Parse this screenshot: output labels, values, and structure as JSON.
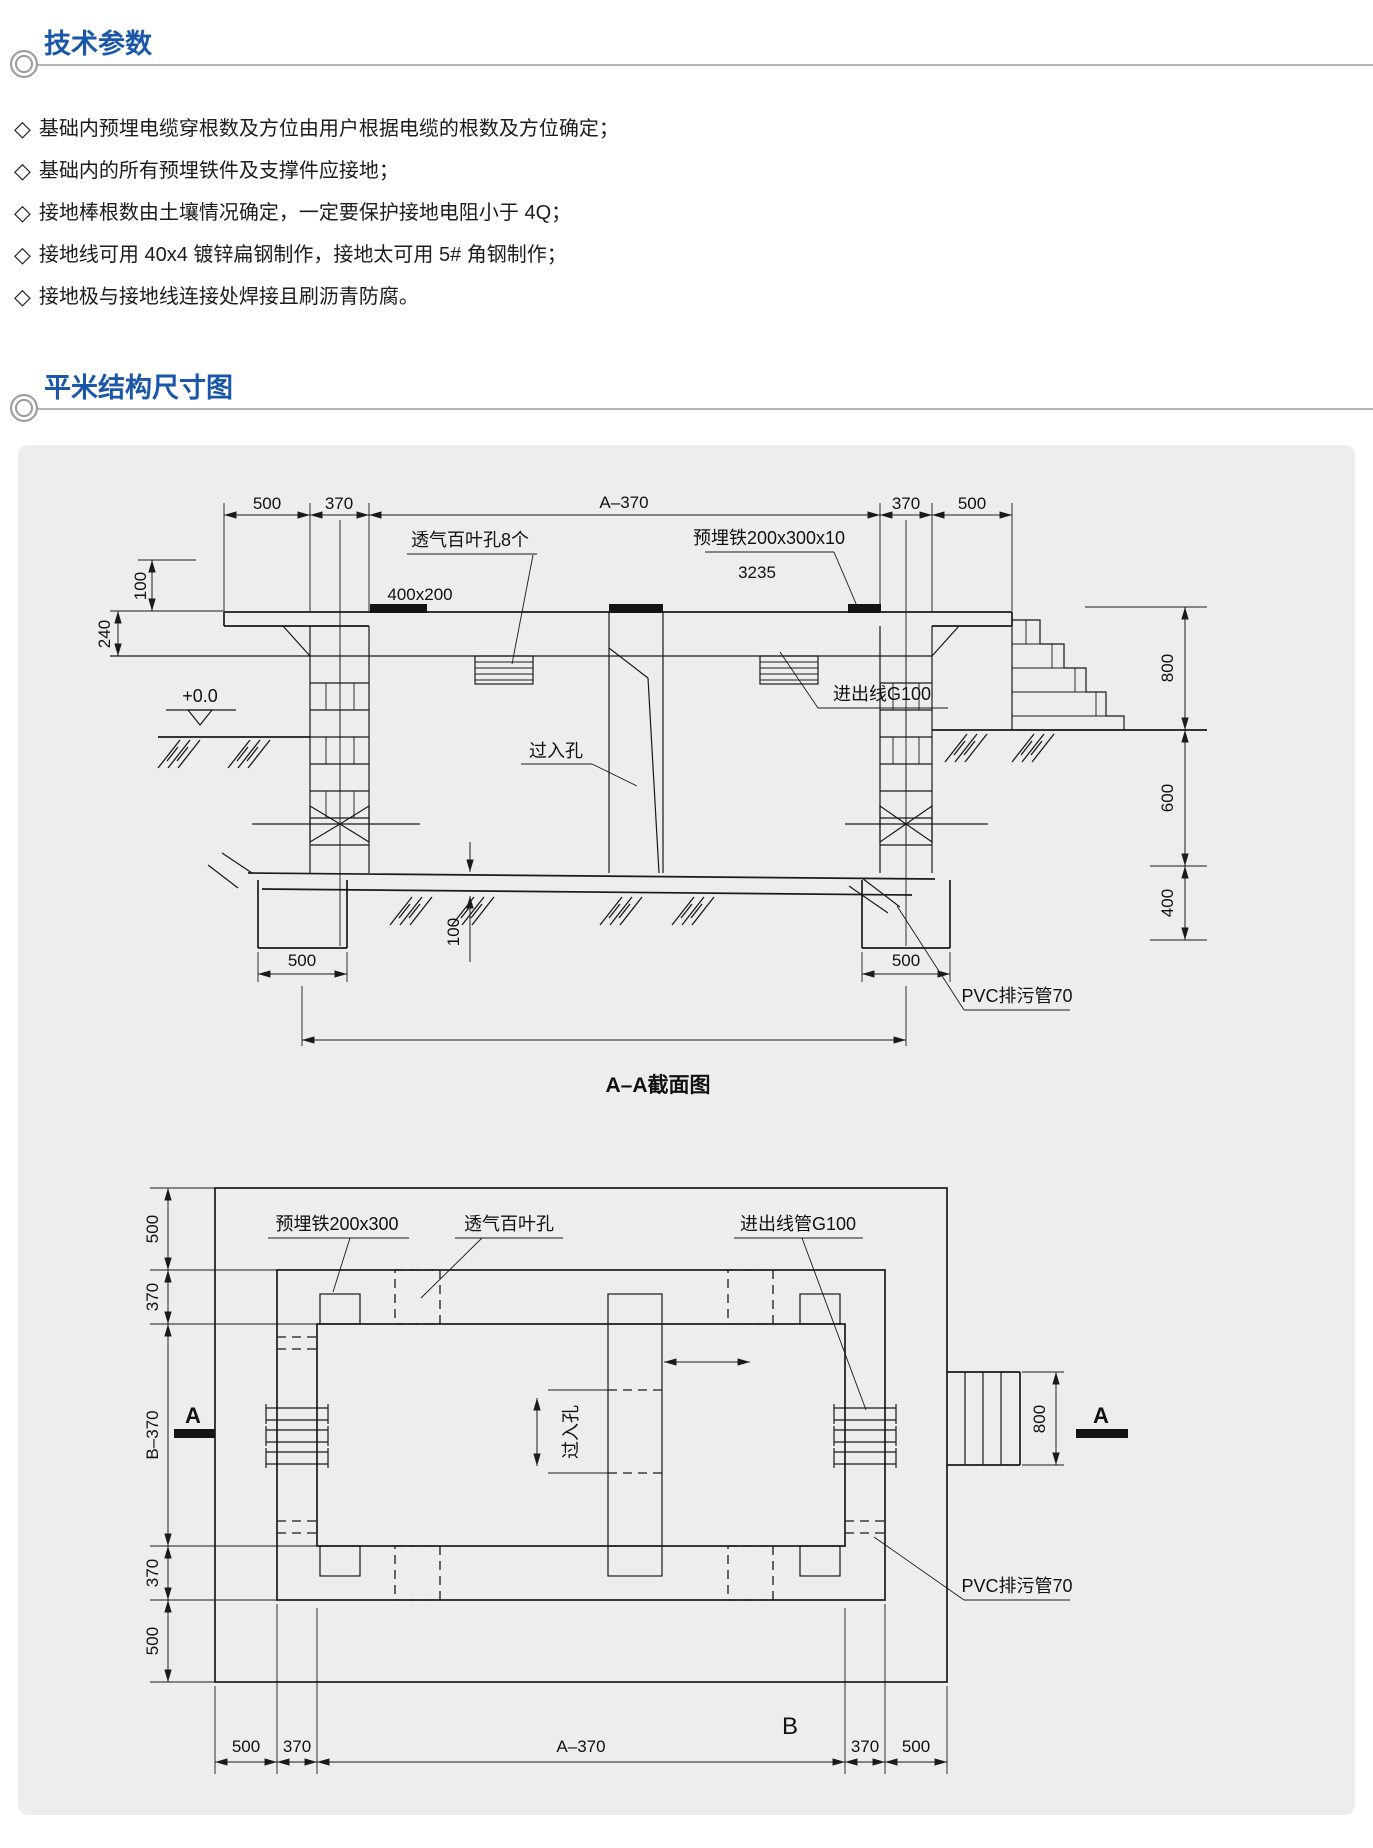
{
  "meta": {
    "bullet_marker": "◇",
    "accent": "#1a57a8",
    "panel_bg": "#ededee",
    "line_color": "#1a1a1a"
  },
  "header": {
    "h1": "技术参数",
    "h2": "平米结构尺寸图"
  },
  "bullets": [
    "基础内预埋电缆穿根数及方位由用户根据电缆的根数及方位确定；",
    "基础内的所有预埋铁件及支撑件应接地；",
    "接地棒根数由土壤情况确定，一定要保护接地电阻小于 4Q；",
    "接地线可用 40x4 镀锌扁钢制作，接地太可用 5# 角钢制作；",
    "接地极与接地线连接处焊接且刷沥青防腐。"
  ],
  "sec": {
    "dims_top": [
      "500",
      "370",
      "A–370",
      "370",
      "500"
    ],
    "dim_100": "100",
    "dim_240": "240",
    "level": "+0.0",
    "size": "400x200",
    "louver": "透气百叶孔8个",
    "plate": "预埋铁200x300x10",
    "total": "3235",
    "manhole": "过入孔",
    "conduit": "进出线G100",
    "pvc": "PVC排污管70",
    "dims_right": [
      "800",
      "600",
      "400"
    ],
    "foot_l": "500",
    "foot_r": "500",
    "floor": "100",
    "title": "A–A截面图"
  },
  "plan": {
    "plate": "预埋铁200x300",
    "louver": "透气百叶孔",
    "conduit": "进出线管G100",
    "pvc": "PVC排污管70",
    "manhole": "过入孔",
    "dims_left": [
      "500",
      "370",
      "B–370",
      "370",
      "500"
    ],
    "dims_bottom": [
      "500",
      "370",
      "A–370",
      "370",
      "500"
    ],
    "sump": "800",
    "marker_left": "A",
    "marker_right": "A",
    "blabel": "B"
  }
}
